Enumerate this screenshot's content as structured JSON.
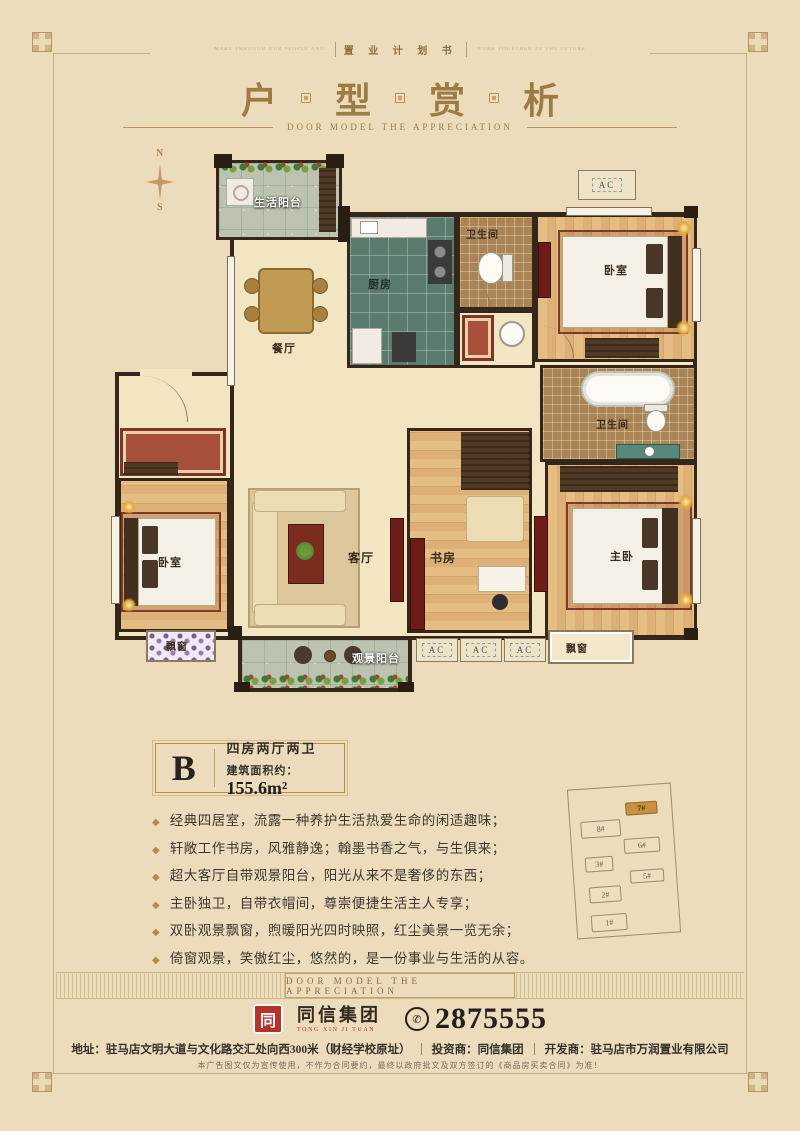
{
  "ui": {
    "bullet": "◆",
    "bg": "#ecdcbc",
    "accent_gold": "#9d7c44",
    "wall_color": "#35261a"
  },
  "top_strip": {
    "left_text": "MAKE THROUGH OUR PEOPLE AND",
    "center_text": "置 业 计 划 书",
    "right_text": "WORK TOGETHER TO THE FUTURE"
  },
  "header": {
    "title_chars": [
      "户",
      "型",
      "赏",
      "析"
    ],
    "subtitle": "DOOR MODEL THE APPRECIATION"
  },
  "compass": {
    "north": "N",
    "south": "S"
  },
  "floorplan": {
    "ac_label": "AC",
    "rooms": {
      "service_balcony": "生活阳台",
      "dining": "餐厅",
      "kitchen": "厨房",
      "bath_top": "卫生间",
      "bath_right": "卫生间",
      "bedroom_top": "卧室",
      "bedroom_left": "卧室",
      "master": "主卧",
      "study": "书房",
      "living": "客厅",
      "view_balcony": "观景阳台",
      "bay_left": "飘窗",
      "bay_right": "飘窗"
    }
  },
  "unit": {
    "letter": "B",
    "layout": "四房两厅两卫",
    "area_label": "建筑面积约：",
    "area_value": "155.6m²"
  },
  "features": [
    "经典四居室，流露一种养护生活热爱生命的闲适趣味；",
    "轩敞工作书房，风雅静逸；翰墨书香之气，与生俱来；",
    "超大客厅自带观景阳台，阳光从来不是奢侈的东西；",
    "主卧独卫，自带衣帽间，尊崇便捷生活主人专享；",
    "双卧观景飘窗，煦暖阳光四时映照，红尘美景一览无余；",
    "倚窗观景，笑傲红尘，悠然的，是一份事业与生活的从容。"
  ],
  "band": {
    "text": "DOOR MODEL THE APPRECIATION"
  },
  "siteplan": {
    "buildings": [
      {
        "label": "7#",
        "highlight": true
      },
      {
        "label": "8#",
        "highlight": false
      },
      {
        "label": "6#",
        "highlight": false
      },
      {
        "label": "3#",
        "highlight": false
      },
      {
        "label": "5#",
        "highlight": false
      },
      {
        "label": "2#",
        "highlight": false
      },
      {
        "label": "1#",
        "highlight": false
      }
    ]
  },
  "footer": {
    "logo_mark": "同",
    "logo_cn": "同信集团",
    "logo_en": "TONG XIN JI TUAN",
    "phone_icon": "✆",
    "phone": "2875555",
    "address": "地址：驻马店文明大道与文化路交汇处向西300米（财经学校原址）",
    "investor": "投资商：同信集团",
    "developer": "开发商：驻马店市万润置业有限公司",
    "disclaimer": "本广告图文仅为宣传使用，不作为合同要约，最终以政府批文及双方签订的《商品房买卖合同》为准！"
  }
}
